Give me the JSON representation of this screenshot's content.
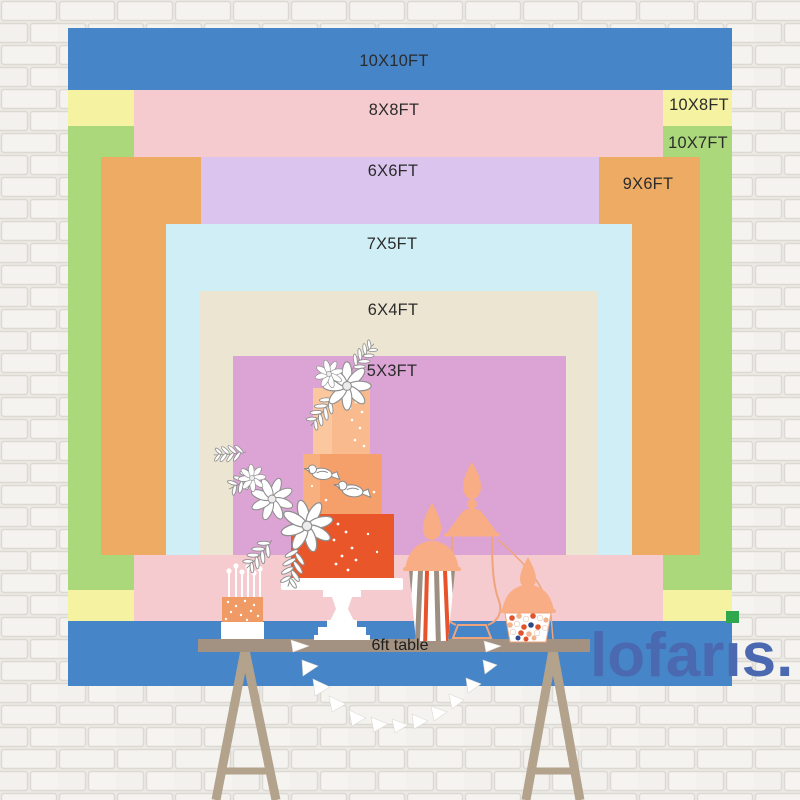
{
  "backdrop": {
    "layers": [
      {
        "label": "10X10FT",
        "color": "#4685c7",
        "x": 68,
        "y": 28,
        "w": 664,
        "h": 658,
        "label_x": 394,
        "label_y": 61
      },
      {
        "label": "10X8FT",
        "color": "#f5f2a1",
        "x": 68,
        "y": 90,
        "w": 664,
        "h": 531,
        "label_x": 699,
        "label_y": 105
      },
      {
        "label": "10X7FT",
        "color": "#aad87b",
        "x": 68,
        "y": 126,
        "w": 664,
        "h": 464,
        "label_x": 698,
        "label_y": 143
      },
      {
        "label": "8X8FT",
        "color": "#f6cbcf",
        "x": 134,
        "y": 90,
        "w": 529,
        "h": 531,
        "label_x": 394,
        "label_y": 110
      },
      {
        "label": "9X6FT",
        "color": "#eeab63",
        "x": 101,
        "y": 157,
        "w": 599,
        "h": 398,
        "label_x": 648,
        "label_y": 184
      },
      {
        "label": "6X6FT",
        "color": "#dbc5ee",
        "x": 201,
        "y": 157,
        "w": 398,
        "h": 398,
        "label_x": 393,
        "label_y": 171
      },
      {
        "label": "7X5FT",
        "color": "#cfeef6",
        "x": 166,
        "y": 224,
        "w": 466,
        "h": 331,
        "label_x": 392,
        "label_y": 244
      },
      {
        "label": "6X4FT",
        "color": "#ece5d2",
        "x": 200,
        "y": 291,
        "w": 398,
        "h": 264,
        "label_x": 393,
        "label_y": 310
      },
      {
        "label": "5X3FT",
        "color": "#dca3d5",
        "x": 233,
        "y": 356,
        "w": 333,
        "h": 199,
        "label_x": 392,
        "label_y": 371
      }
    ],
    "label_color": "#2b2b2b"
  },
  "table": {
    "label": "6ft table",
    "surface_color": "#a39181",
    "leg_color": "#b3a28c"
  },
  "decor": {
    "cake_tier_colors": [
      "#f9bb8e",
      "#f5a06b",
      "#e9562a"
    ],
    "jar_peach": "#f8ad85",
    "jar_outline": "#efa47c",
    "stripe_taupe": "#9d9082",
    "stripe_orange": "#e8532c",
    "garland_color": "#ffffff"
  },
  "brand": {
    "name": "lofaris",
    "suffix": ".",
    "color": "#4a69b0",
    "accent_color": "#2fa84d"
  }
}
